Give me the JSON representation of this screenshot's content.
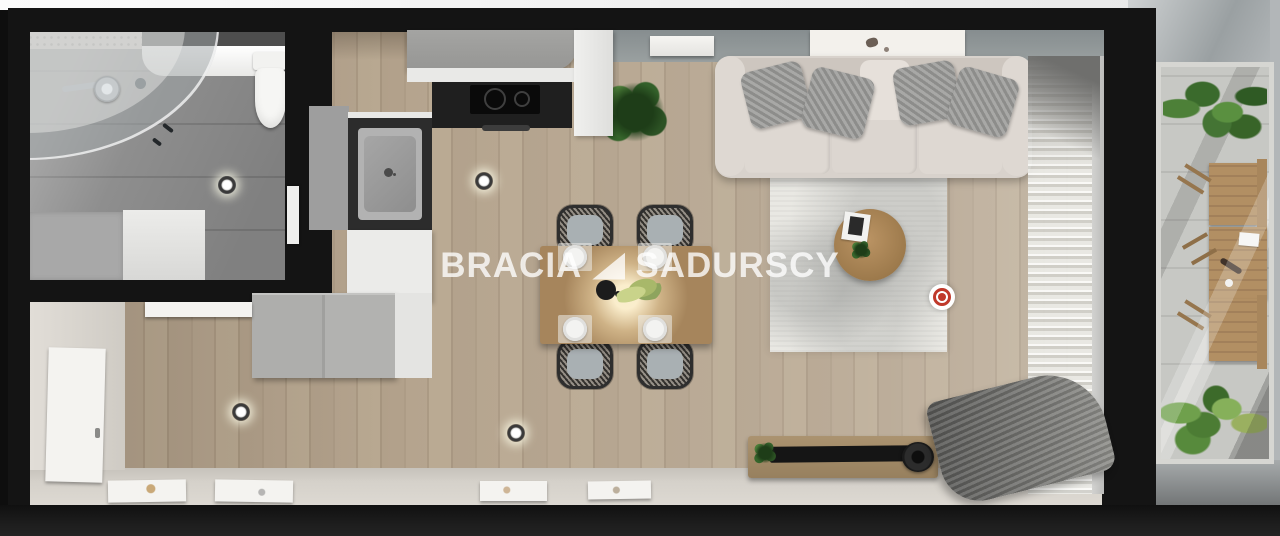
{
  "watermark": {
    "text_left": "BRACIA",
    "text_right": "SADURSCY",
    "logo": "triangle"
  },
  "icons": {
    "hotspot-marker": "red-bullseye",
    "ceiling-light": "recessed-spotlight",
    "watermark-logo": "solid-right-triangle"
  },
  "palette": {
    "wall": "#141414",
    "wood": "#b5a48e",
    "tile": "#8e8e8e",
    "rug": "#e9e8e3",
    "sofa": "#d8d2cc",
    "pillow": "#8d8d8b",
    "table-wood": "#a6855c",
    "counter-black": "#1f1f1f",
    "cabinet-gray": "#9e9e9e",
    "cabinet-white": "#ebebe9",
    "beige-floor": "#d5d1ca",
    "paver": "#c7c8c4",
    "accent-red": "#c0392b",
    "outside-gray": "#b2b6b8",
    "outside-light": "#f4f4f4"
  }
}
